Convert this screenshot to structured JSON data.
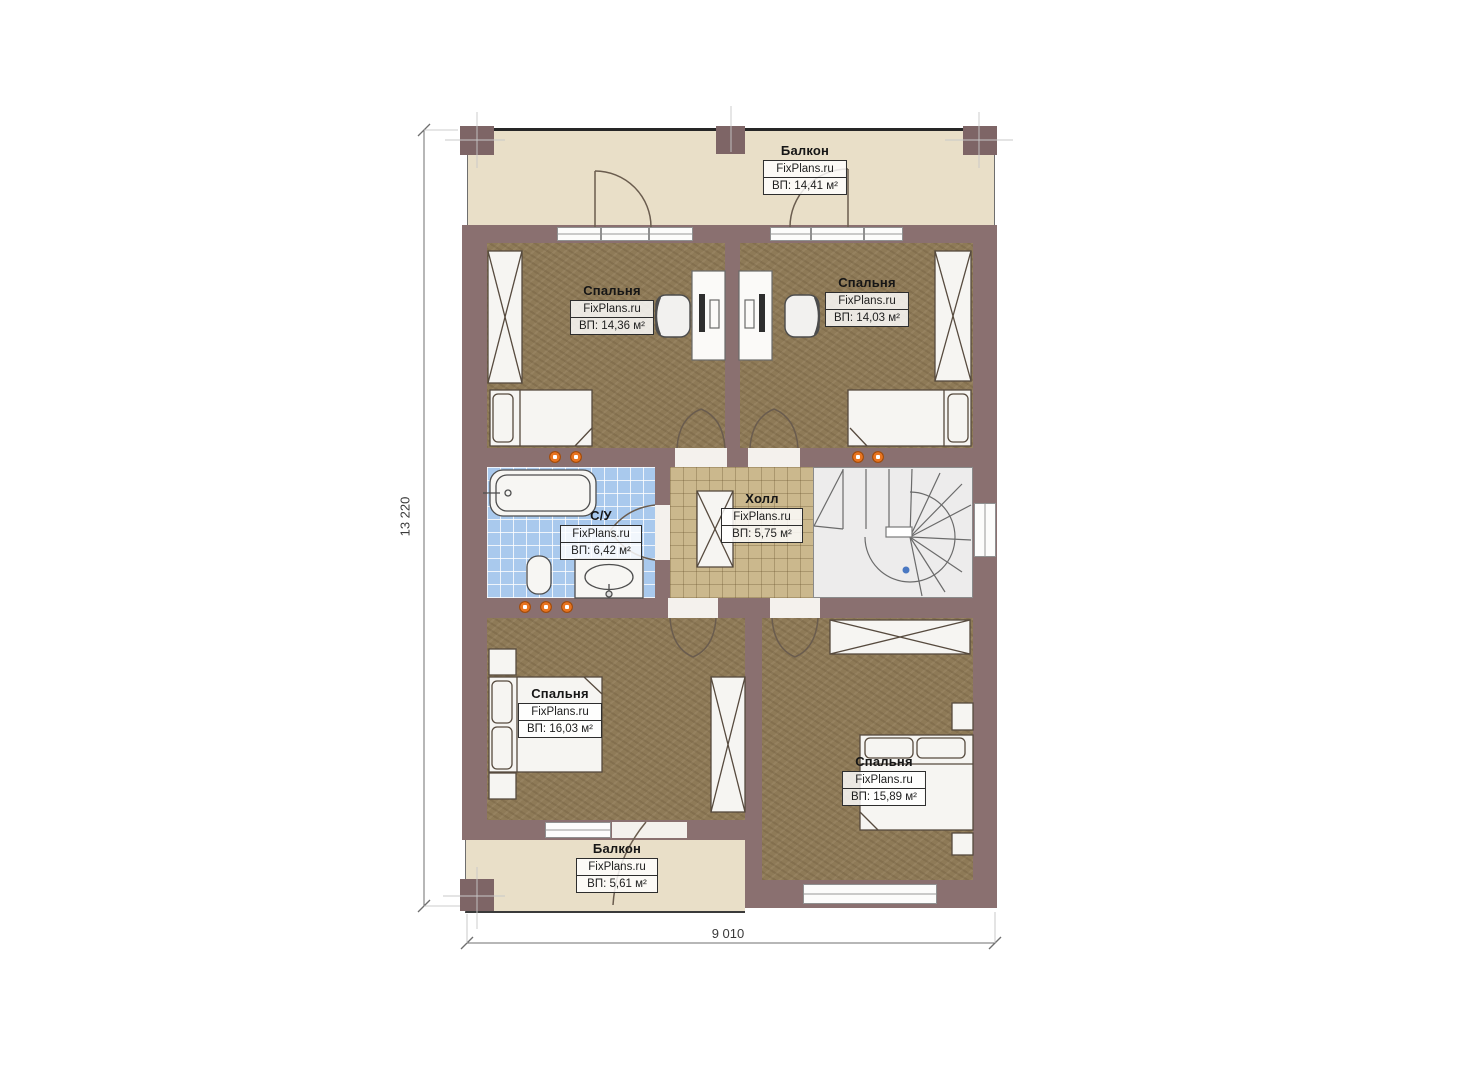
{
  "plan": {
    "brand": "FixPlans.ru",
    "dimensions": {
      "vertical": "13 220",
      "horizontal": "9 010"
    },
    "rooms": {
      "balcony_top": {
        "name": "Балкон",
        "brand": "FixPlans.ru",
        "area": "ВП: 14,41 м²"
      },
      "bedroom_top_left": {
        "name": "Спальня",
        "brand": "FixPlans.ru",
        "area": "ВП: 14,36 м²"
      },
      "bedroom_top_right": {
        "name": "Спальня",
        "brand": "FixPlans.ru",
        "area": "ВП: 14,03 м²"
      },
      "bathroom": {
        "name": "С/У",
        "brand": "FixPlans.ru",
        "area": "ВП: 6,42 м²"
      },
      "hall": {
        "name": "Холл",
        "brand": "FixPlans.ru",
        "area": "ВП: 5,75 м²"
      },
      "bedroom_bottom_left": {
        "name": "Спальня",
        "brand": "FixPlans.ru",
        "area": "ВП: 16,03 м²"
      },
      "bedroom_bottom_right": {
        "name": "Спальня",
        "brand": "FixPlans.ru",
        "area": "ВП: 15,89 м²"
      },
      "balcony_bottom": {
        "name": "Балкон",
        "brand": "FixPlans.ru",
        "area": "ВП: 5,61 м²"
      }
    },
    "colors": {
      "wall": "#8a7070",
      "wall_dark": "#7e6566",
      "bedroom_floor": "#8e7a57",
      "hall_floor": "#cbb88d",
      "bath_floor": "#a9c9ed",
      "balcony_floor": "#e9dfc8",
      "stair_floor": "#edecec",
      "socket": "#e87420",
      "marker": "#4a78c2"
    }
  }
}
